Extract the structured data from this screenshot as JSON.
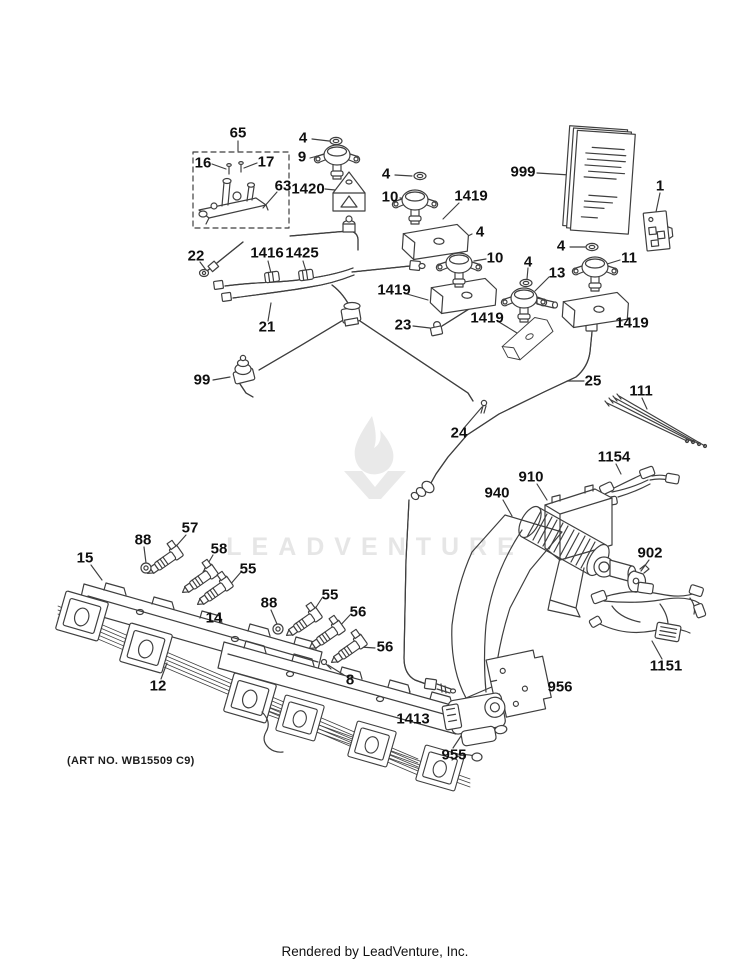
{
  "page": {
    "background": "#ffffff",
    "art_no": "(ART NO. WB15509 C9)",
    "footer": "Rendered by LeadVenture, Inc.",
    "line_color": "#3f3f3f",
    "label_color": "#0f0f0f"
  },
  "watermark": {
    "text": "LEADVENTURE",
    "color": "#e6e6e6",
    "logo": "leadventure-flame-v-logo"
  },
  "diagram": {
    "description": "Exploded parts diagram - gas range valves, manifold tubing, burner rails and blower",
    "labels": [
      {
        "text": "65",
        "x": 238,
        "y": 133
      },
      {
        "text": "16",
        "x": 203,
        "y": 163
      },
      {
        "text": "17",
        "x": 266,
        "y": 162
      },
      {
        "text": "63",
        "x": 283,
        "y": 186
      },
      {
        "text": "4",
        "x": 303,
        "y": 138
      },
      {
        "text": "9",
        "x": 302,
        "y": 157
      },
      {
        "text": "1420",
        "x": 308,
        "y": 189
      },
      {
        "text": "999",
        "x": 523,
        "y": 172
      },
      {
        "text": "1",
        "x": 660,
        "y": 186
      },
      {
        "text": "4",
        "x": 386,
        "y": 174
      },
      {
        "text": "10",
        "x": 390,
        "y": 197
      },
      {
        "text": "1419",
        "x": 471,
        "y": 196
      },
      {
        "text": "22",
        "x": 196,
        "y": 256
      },
      {
        "text": "1416",
        "x": 267,
        "y": 253
      },
      {
        "text": "1425",
        "x": 302,
        "y": 253
      },
      {
        "text": "21",
        "x": 267,
        "y": 327
      },
      {
        "text": "4",
        "x": 480,
        "y": 232
      },
      {
        "text": "10",
        "x": 495,
        "y": 258
      },
      {
        "text": "1419",
        "x": 394,
        "y": 290
      },
      {
        "text": "4",
        "x": 528,
        "y": 262
      },
      {
        "text": "13",
        "x": 557,
        "y": 273
      },
      {
        "text": "4",
        "x": 561,
        "y": 246
      },
      {
        "text": "11",
        "x": 629,
        "y": 258
      },
      {
        "text": "1419",
        "x": 487,
        "y": 318
      },
      {
        "text": "1419",
        "x": 632,
        "y": 323
      },
      {
        "text": "23",
        "x": 403,
        "y": 325
      },
      {
        "text": "99",
        "x": 202,
        "y": 380
      },
      {
        "text": "25",
        "x": 593,
        "y": 381
      },
      {
        "text": "24",
        "x": 459,
        "y": 433
      },
      {
        "text": "111",
        "x": 641,
        "y": 391
      },
      {
        "text": "1154",
        "x": 614,
        "y": 457
      },
      {
        "text": "940",
        "x": 497,
        "y": 493
      },
      {
        "text": "910",
        "x": 531,
        "y": 477
      },
      {
        "text": "902",
        "x": 650,
        "y": 553
      },
      {
        "text": "57",
        "x": 190,
        "y": 528
      },
      {
        "text": "88",
        "x": 143,
        "y": 540
      },
      {
        "text": "58",
        "x": 219,
        "y": 549
      },
      {
        "text": "55",
        "x": 248,
        "y": 569
      },
      {
        "text": "15",
        "x": 85,
        "y": 558
      },
      {
        "text": "14",
        "x": 214,
        "y": 618
      },
      {
        "text": "88",
        "x": 269,
        "y": 603
      },
      {
        "text": "55",
        "x": 330,
        "y": 595
      },
      {
        "text": "56",
        "x": 358,
        "y": 612
      },
      {
        "text": "56",
        "x": 385,
        "y": 647
      },
      {
        "text": "8",
        "x": 350,
        "y": 680
      },
      {
        "text": "12",
        "x": 158,
        "y": 686
      },
      {
        "text": "1413",
        "x": 413,
        "y": 719
      },
      {
        "text": "956",
        "x": 560,
        "y": 687
      },
      {
        "text": "955",
        "x": 454,
        "y": 755
      },
      {
        "text": "1151",
        "x": 666,
        "y": 666
      }
    ]
  }
}
